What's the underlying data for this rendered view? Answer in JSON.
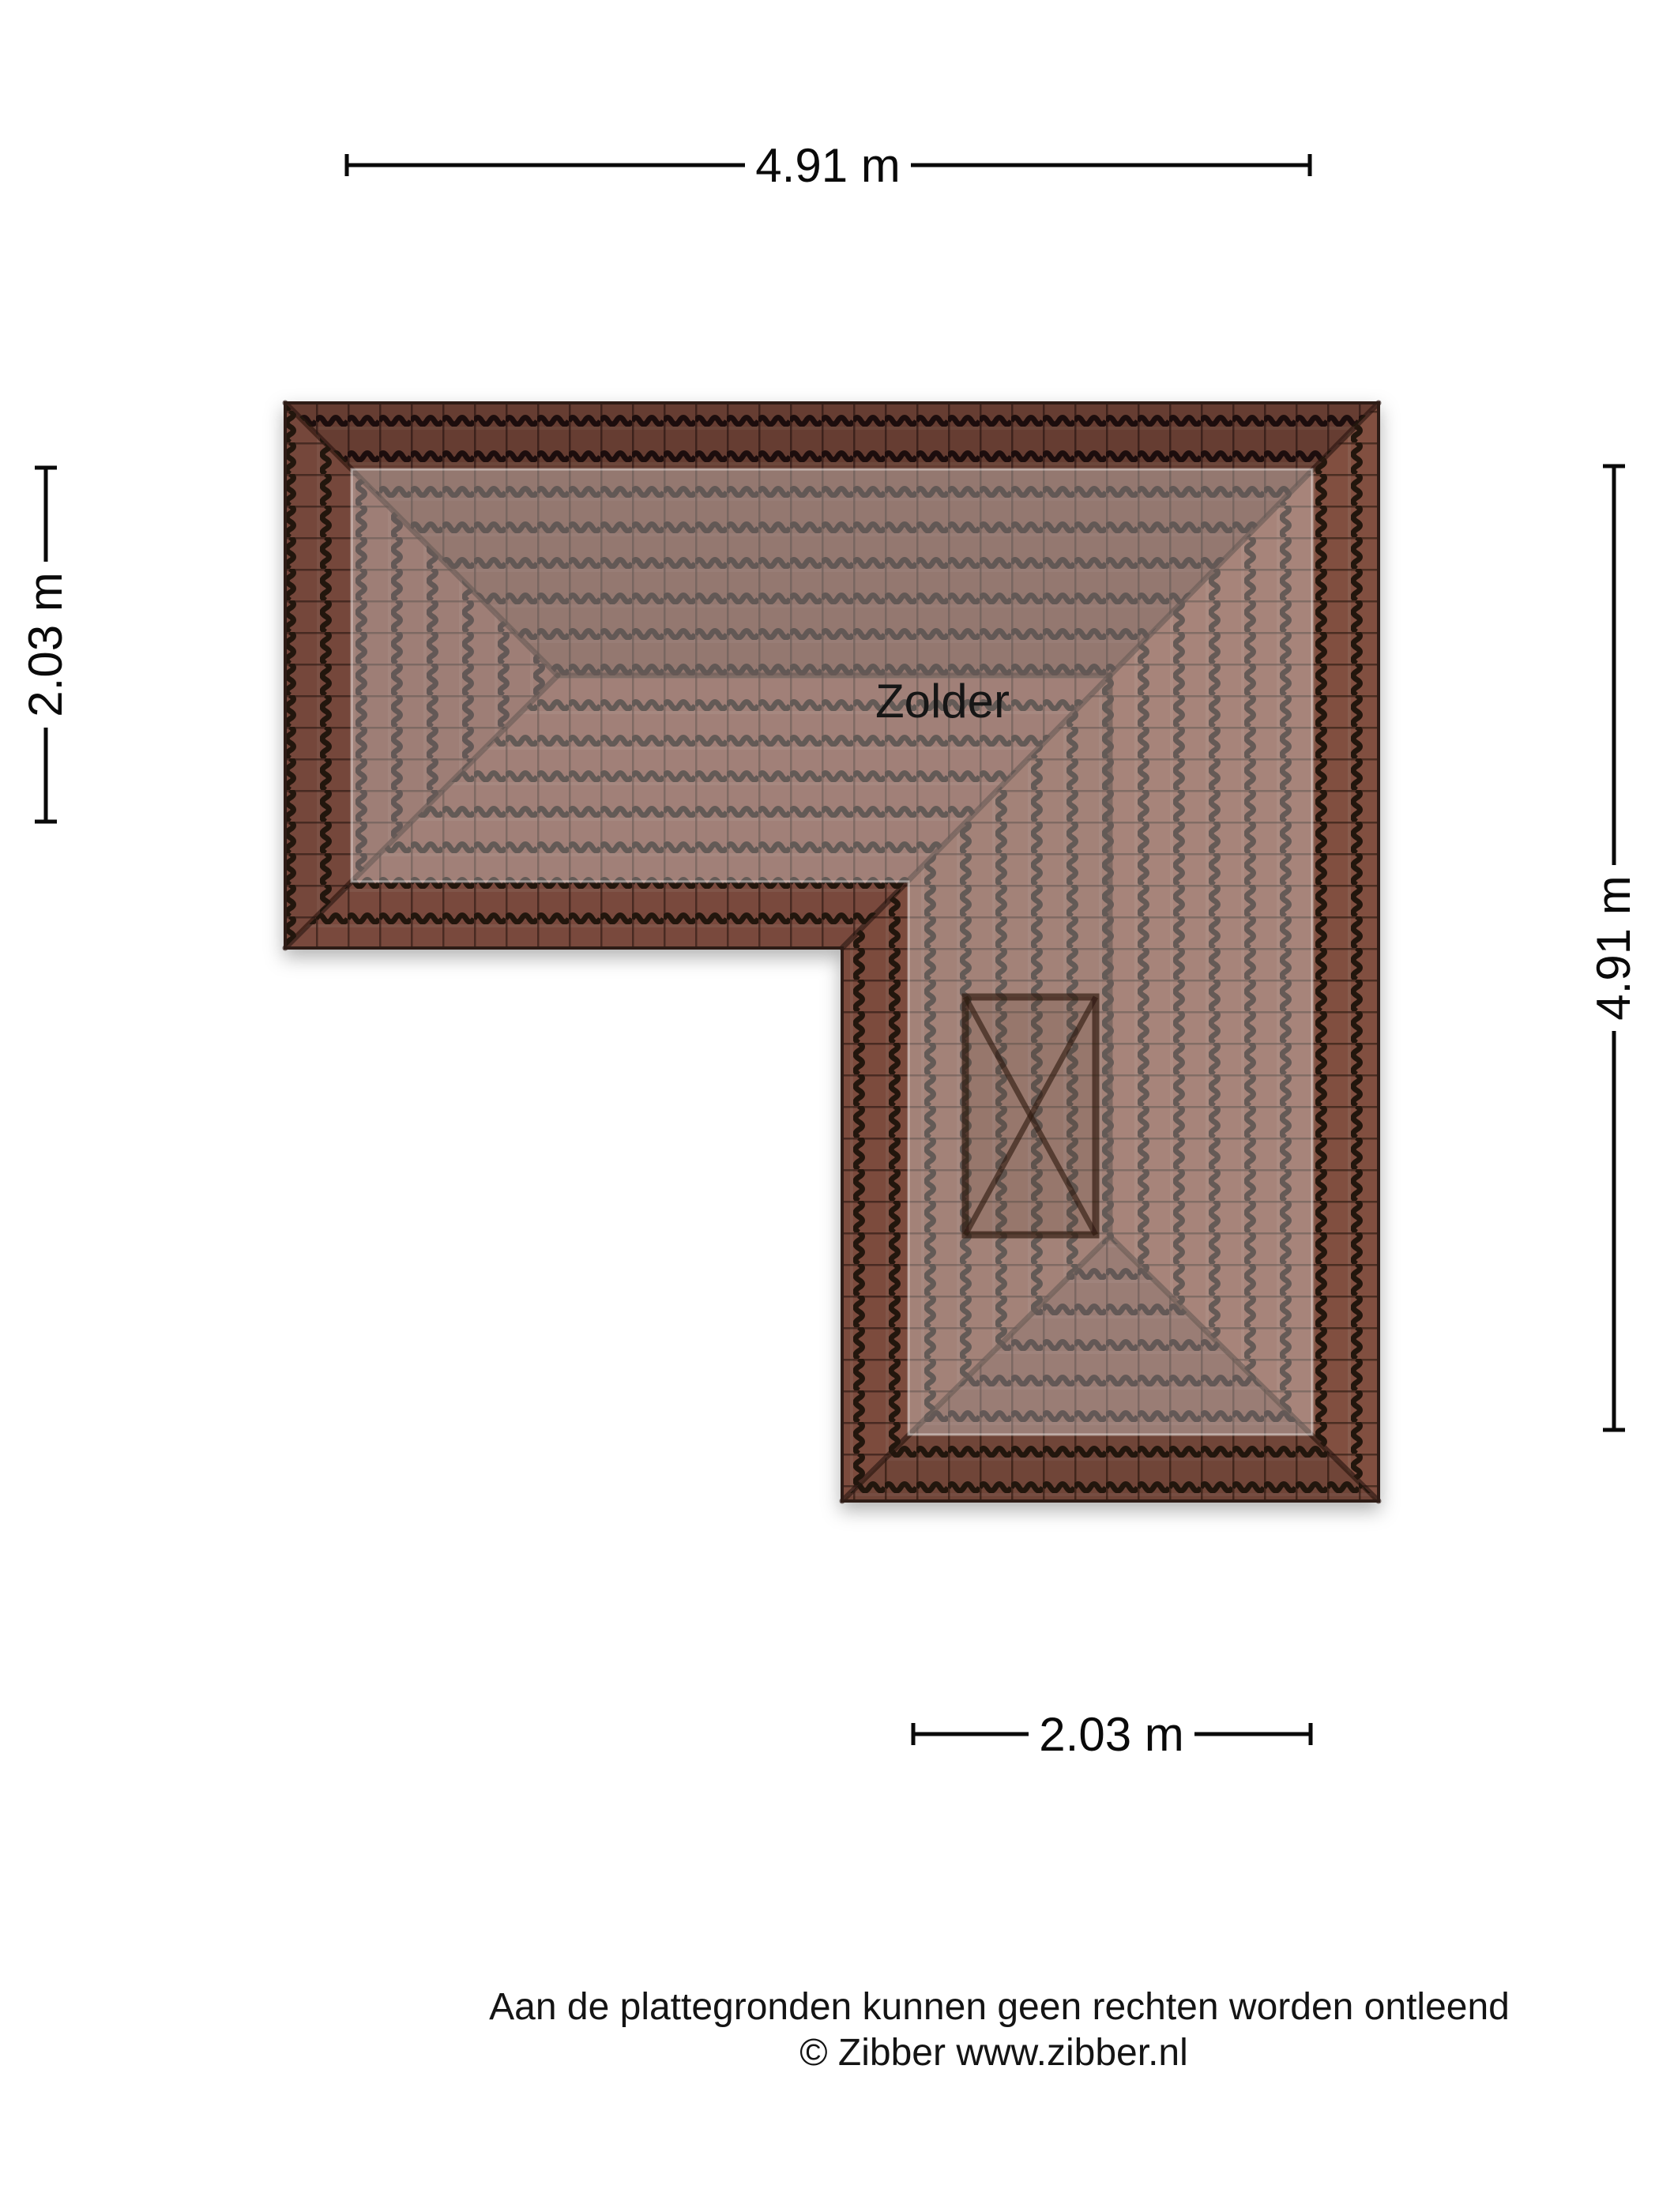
{
  "document": {
    "type": "floorplan-roof-view",
    "background_color": "#ffffff"
  },
  "floorplan": {
    "room_label": "Zolder",
    "roof_shape": "L-shaped hipped roof, top-down view",
    "skylight": "rectangle with X cross marking on lower wing",
    "colors": {
      "tile_base": "#8a5647",
      "tile_gap": "#241511",
      "eaves_outline": "#2e1a12",
      "floor_overlay": "rgba(255,255,255,0.30)"
    }
  },
  "dimensions": {
    "units": "m",
    "top": {
      "label": "4.91 m",
      "value": 4.91,
      "orientation": "horizontal"
    },
    "left": {
      "label": "2.03 m",
      "value": 2.03,
      "orientation": "vertical"
    },
    "right": {
      "label": "4.91 m",
      "value": 4.91,
      "orientation": "vertical"
    },
    "bottom": {
      "label": "2.03 m",
      "value": 2.03,
      "orientation": "horizontal"
    }
  },
  "footer": {
    "disclaimer": "Aan de plattegronden kunnen geen rechten worden ontleend",
    "copyright": "© Zibber www.zibber.nl"
  }
}
